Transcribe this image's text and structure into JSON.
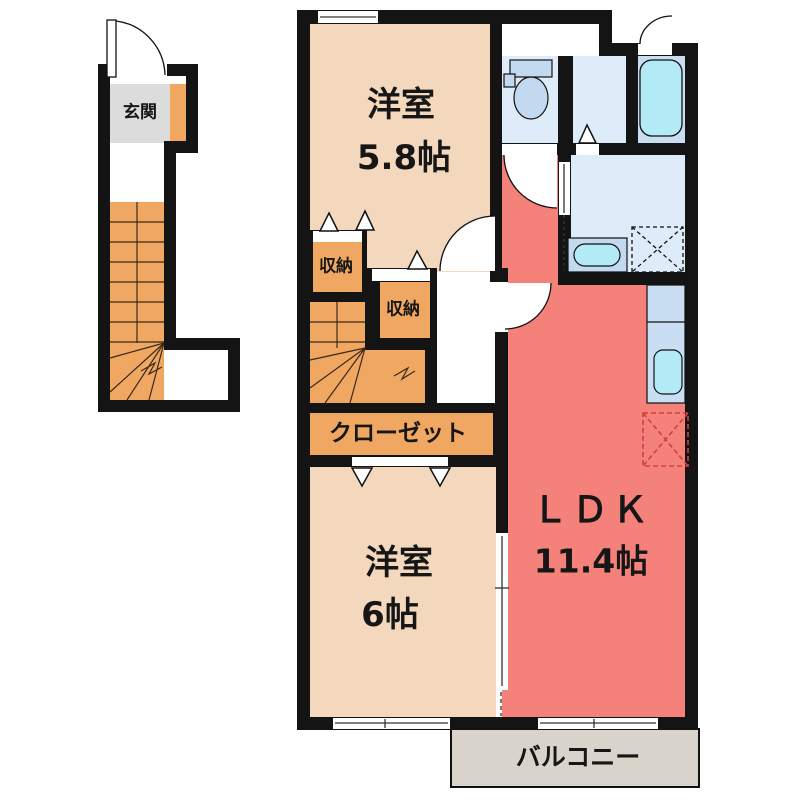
{
  "plan_title": "2F floor plan",
  "rooms": {
    "genkan": {
      "label": "玄関"
    },
    "western_room_1": {
      "label": "洋室",
      "size": "5.8帖"
    },
    "western_room_2": {
      "label": "洋室",
      "size": "6帖"
    },
    "ldk": {
      "label": "ＬＤＫ",
      "size": "11.4帖"
    },
    "storage_1": {
      "label": "収納"
    },
    "storage_2": {
      "label": "収納"
    },
    "closet": {
      "label": "クローゼット"
    },
    "balcony": {
      "label": "バルコニー"
    }
  },
  "colors": {
    "wall": "#141414",
    "floor_peach": "#F4D8BD",
    "accent_orange": "#EFA761",
    "ldk_red": "#F5817B",
    "genkan_gray": "#DCDCDC",
    "balcony_gray": "#D9D4CB",
    "bath_floor": "#DEEBF8",
    "bath_mid": "#C9DEF2",
    "fixture_blue": "#C3D9F0",
    "sink_cyan": "#B2EAF5",
    "fridge_red": "#D04040"
  }
}
